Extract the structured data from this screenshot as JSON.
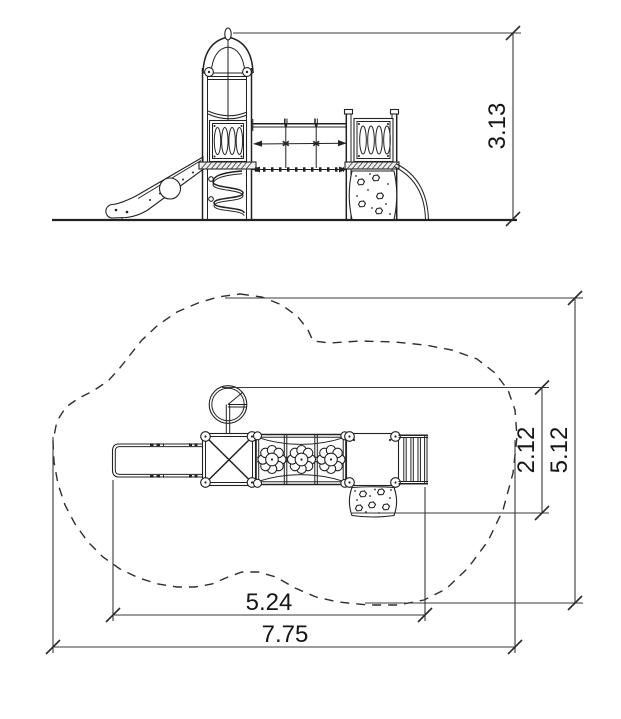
{
  "drawing": {
    "type": "playground-equipment-technical-drawing",
    "views": {
      "elevation": {
        "name": "side-elevation",
        "height_dim": "3.13"
      },
      "plan": {
        "name": "top-plan-with-safety-zone",
        "equipment_width_dim": "5.24",
        "safety_zone_width_dim": "7.75",
        "equipment_depth_dim": "2.12",
        "safety_zone_depth_dim": "5.12"
      }
    },
    "colors": {
      "line": "#222222",
      "background": "#ffffff",
      "text": "#161616"
    }
  }
}
